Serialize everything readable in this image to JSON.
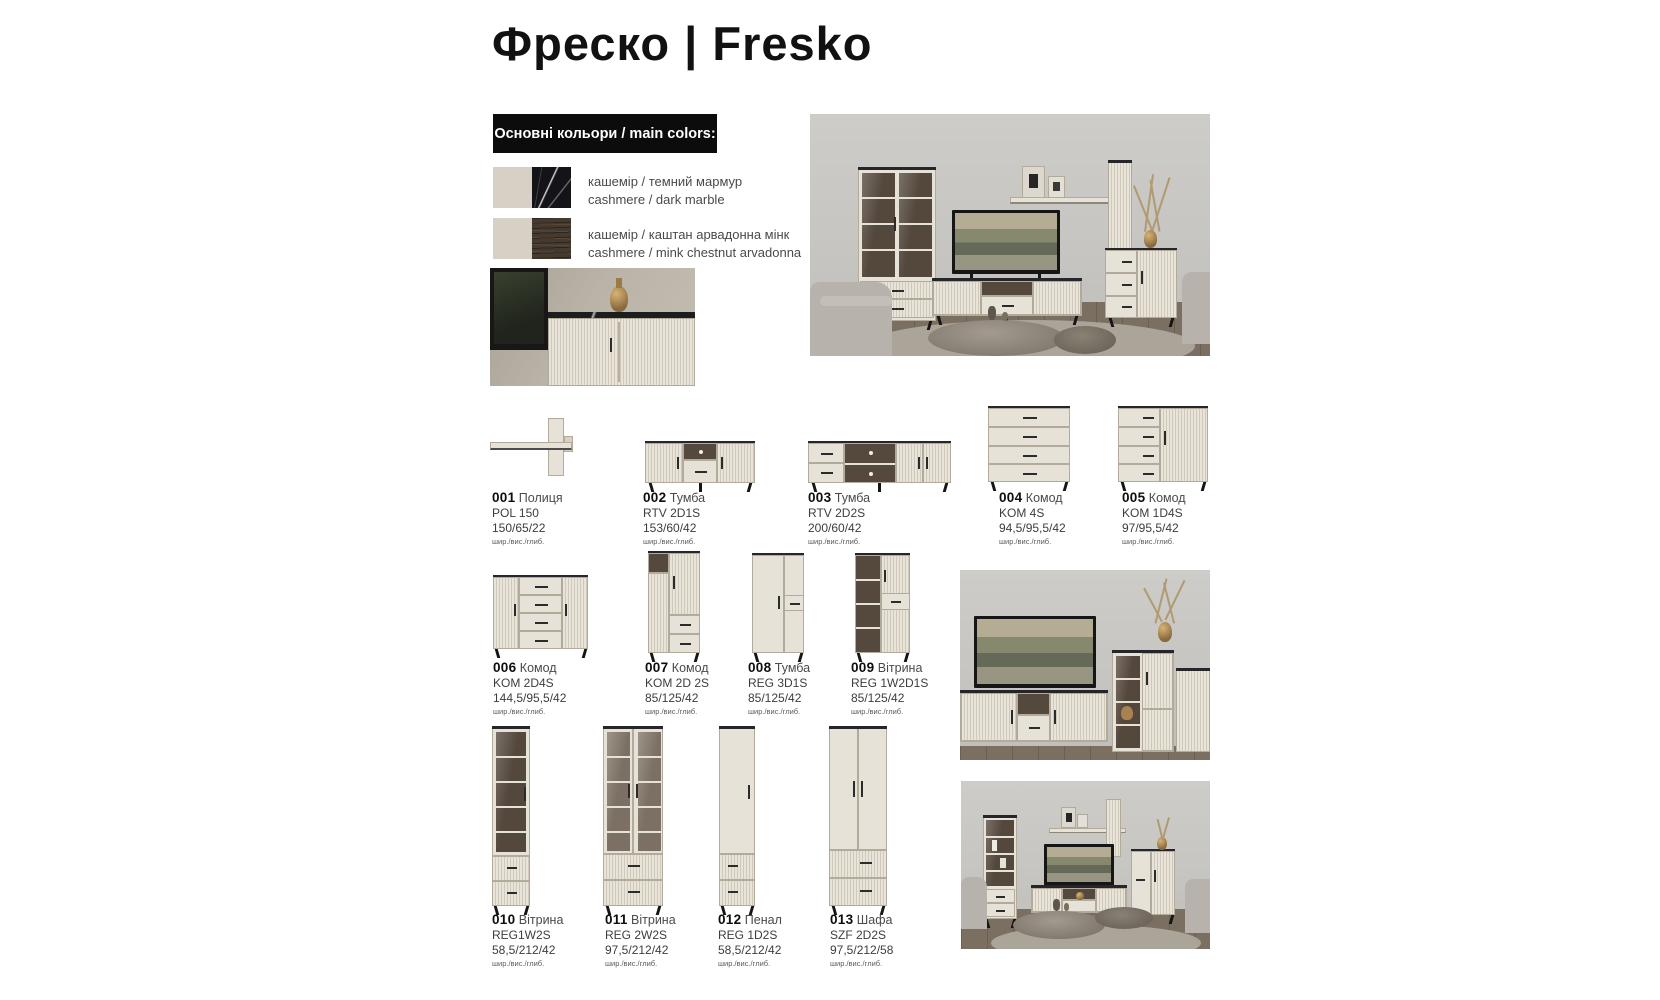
{
  "page": {
    "title": "Фреско | Fresko"
  },
  "colors_panel": {
    "heading": "Основні кольори / main colors:",
    "swatches": [
      {
        "label_uk": "кашемір / темний мармур",
        "label_en": "cashmere / dark marble",
        "left_hex": "#d6d1c4",
        "right_hex": "#141418",
        "right_texture": "marble"
      },
      {
        "label_uk": "кашемір / каштан арвадонна мінк",
        "label_en": "cashmere / mink chestnut arvadonna",
        "left_hex": "#d6d1c4",
        "right_hex": "#453a30",
        "right_texture": "wood"
      }
    ]
  },
  "dimension_note": "шир./вис./глиб.",
  "products": [
    {
      "num": "001",
      "name": "Полиця",
      "code": "POL 150",
      "dims": "150/65/22"
    },
    {
      "num": "002",
      "name": "Тумба",
      "code": "RTV 2D1S",
      "dims": "153/60/42"
    },
    {
      "num": "003",
      "name": "Тумба",
      "code": "RTV 2D2S",
      "dims": "200/60/42"
    },
    {
      "num": "004",
      "name": "Комод",
      "code": "KOM 4S",
      "dims": "94,5/95,5/42"
    },
    {
      "num": "005",
      "name": "Комод",
      "code": "KOM 1D4S",
      "dims": "97/95,5/42"
    },
    {
      "num": "006",
      "name": "Комод",
      "code": "KOM 2D4S",
      "dims": "144,5/95,5/42"
    },
    {
      "num": "007",
      "name": "Комод",
      "code": "KOM 2D 2S",
      "dims": "85/125/42"
    },
    {
      "num": "008",
      "name": "Тумба",
      "code": "REG 3D1S",
      "dims": "85/125/42"
    },
    {
      "num": "009",
      "name": "Вітрина",
      "code": "REG 1W2D1S",
      "dims": "85/125/42"
    },
    {
      "num": "010",
      "name": "Вітрина",
      "code": "REG1W2S",
      "dims": "58,5/212/42"
    },
    {
      "num": "011",
      "name": "Вітрина",
      "code": "REG 2W2S",
      "dims": "97,5/212/42"
    },
    {
      "num": "012",
      "name": "Пенал",
      "code": "REG 1D2S",
      "dims": "58,5/212/42"
    },
    {
      "num": "013",
      "name": "Шафа",
      "code": "SZF 2D2S",
      "dims": "97,5/212/58"
    }
  ],
  "theme": {
    "furniture_beige": "#e7e2d7",
    "cashmere": "#d6d1c4",
    "dark_marble": "#141418",
    "mink_chestnut": "#453a30",
    "label_text": "#3d3d3d",
    "heading_bg": "#0c0c0c"
  }
}
